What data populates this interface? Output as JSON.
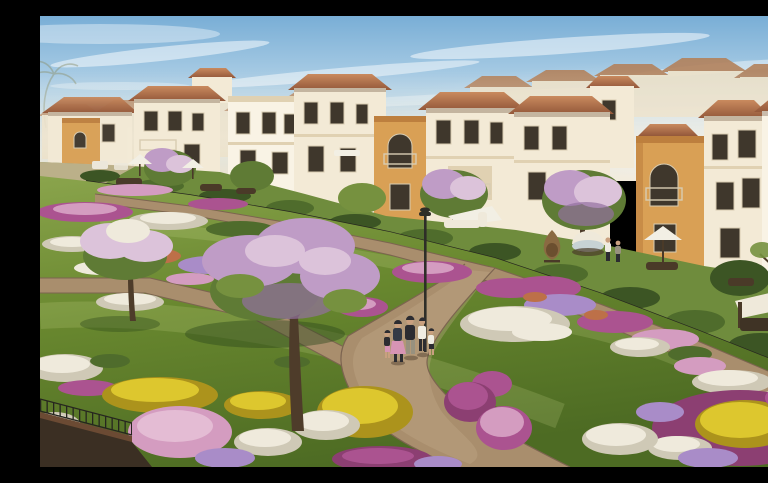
{
  "meta": {
    "kind": "architectural-rendering",
    "width_px": 768,
    "height_px": 451
  },
  "scene": {
    "title": "Mediterranean villa community with linear garden park",
    "description": "Sunny aerial rendering of a Mediterranean-style residential community: rows of two-storey cream and ochre villas with terracotta hipped roofs sit behind a black metal picket fence; in front, a landscaped linear park with curving tan walking paths, flower beds in magenta, pink, white, yellow and lilac, blossoming trees, a park lamppost, and a family of five strolling along the main path.",
    "sky": {
      "condition": "clear blue with wispy cirrus clouds",
      "light": "bright daylight from the right"
    },
    "buildings": {
      "style": "Mediterranean villas",
      "storeys": 2,
      "wall_colors": [
        "cream",
        "white",
        "ochre"
      ],
      "roof_type": "terracotta hipped",
      "details": [
        "arched balconies",
        "dark window openings",
        "parapet cornices"
      ]
    },
    "backyards": {
      "fence": "black metal picket fence",
      "items": [
        "white patio umbrellas",
        "shade sail",
        "outdoor sofa sets",
        "hanging cocoon chair",
        "canopied round daybed",
        "pergola seating"
      ],
      "people_standing": 2
    },
    "park": {
      "paths": 3,
      "path_material": "tan gravel",
      "flower_colors": [
        "magenta",
        "pink",
        "white",
        "yellow",
        "lilac",
        "orange"
      ],
      "trees": [
        "large lilac-blossom tree",
        "white-blossom tree",
        "green canopies"
      ],
      "lamppost": 1,
      "planter_wall": "dark brick planter at lower-left"
    },
    "people": {
      "walking_on_main_path": 5,
      "activity": "family strolling"
    }
  },
  "palette": {
    "sky_top": "#79aed6",
    "sky_mid": "#b9d6e9",
    "sky_low": "#e0e4dd",
    "sky_horizon": "#eee4d0",
    "cloud": "#ffffff",
    "wall_distant": "#ece1c9",
    "roof_distant": "#b3825c",
    "wall_cream": "#f3ead6",
    "wall_light": "#f9f3e5",
    "wall_shade": "#e0d1b2",
    "accent_ochre": "#d9a055",
    "accent_ochre_deep": "#bd7f3e",
    "roof_terra_light": "#c98a5e",
    "roof_terra_dark": "#94583a",
    "window_dark": "#3f372c",
    "window_frame": "#d8ccb2",
    "fence_dark": "#26261f",
    "street_haze": "#c9b697",
    "car_white": "#ece7da",
    "lawn_back": "#6f8c3d",
    "lawn_light": "#8aa44c",
    "lawn_mid": "#69882f",
    "lawn_dark": "#4d6b23",
    "hedge_dark": "#3c5524",
    "hedge_mid": "#4f6c2c",
    "path_tan": "#a98e6d",
    "path_light": "#c4ab89",
    "path_edge": "#7c6450",
    "trunk_brown": "#4e3c2a",
    "tree_green": "#5f7b35",
    "tree_green_light": "#76913f",
    "blossom_lilac": "#bf9cc6",
    "blossom_light": "#dcc3da",
    "blossom_deep": "#93719f",
    "flower_magenta": "#ab5390",
    "flower_magenta_deep": "#8c3f72",
    "flower_pink": "#d49cc0",
    "flower_pink_light": "#e4bcd4",
    "flower_white": "#efeadc",
    "flower_white_shade": "#cfc9b6",
    "flower_yellow": "#ddc72e",
    "flower_yellow_deep": "#ac931c",
    "flower_lilac": "#a98cc8",
    "flower_orange": "#bd7048",
    "umbrella_white": "#f2efe4",
    "furniture_dark": "#4a3a28",
    "wicker": "#8a6a42",
    "daybed_white": "#efe9da",
    "skin": "#c9a07f",
    "outfit_navy": "#333a46",
    "outfit_white": "#efece2",
    "outfit_pink": "#d794b4",
    "outfit_dark": "#2c2c31",
    "outfit_gray": "#98917f",
    "wall_planter_front": "#3b2f23",
    "wall_planter_top": "#6b4a33",
    "lamp_dark": "#2e2e28"
  }
}
